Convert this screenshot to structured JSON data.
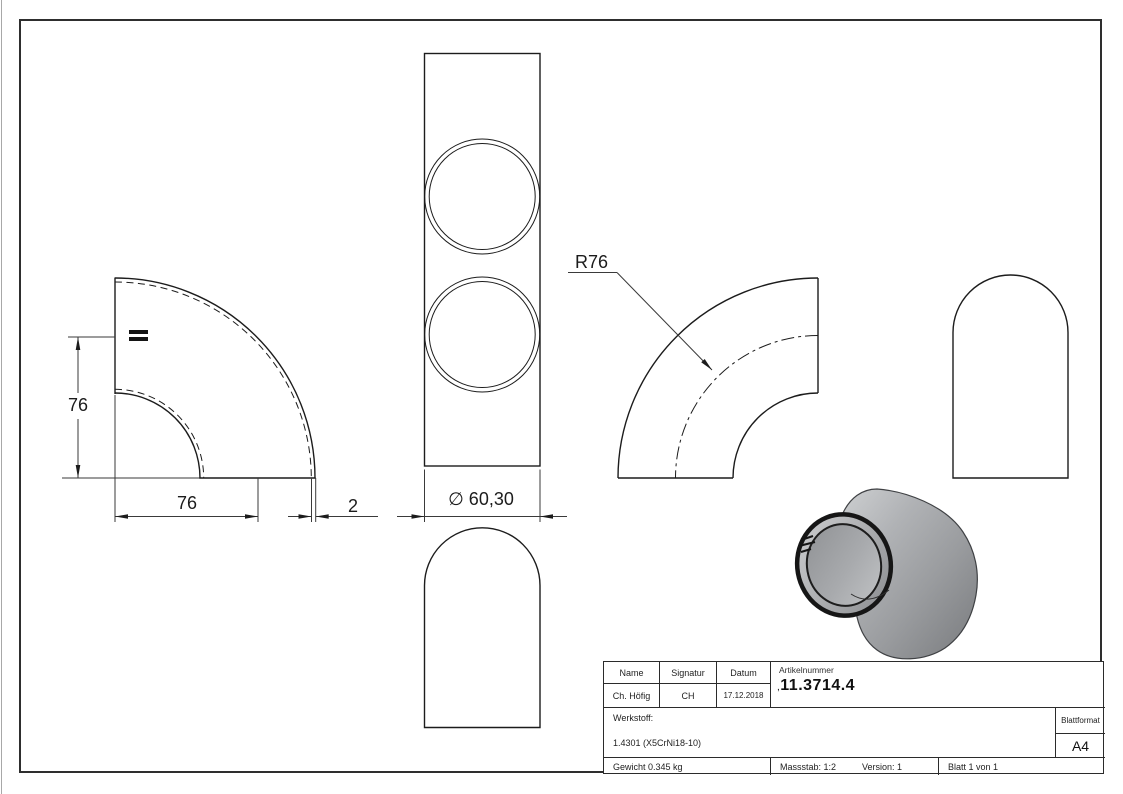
{
  "colors": {
    "line": "#1c1c1c",
    "dim_line": "#3a3a3a",
    "border": "#2e2e2e",
    "render_body_gray": "#a4a6a9",
    "render_rim_black": "#161616"
  },
  "dims": {
    "height": "76",
    "length": "76",
    "wall": "2",
    "diameter": "∅ 60,30",
    "radius": "R76"
  },
  "title_block": {
    "headers": {
      "name": "Name",
      "signature": "Signatur",
      "date": "Datum"
    },
    "values": {
      "name": "Ch. Höfig",
      "signature": "CH",
      "date": "17.12.2018"
    },
    "article": {
      "label": "Artikelnummer",
      "prefix": ",",
      "number": "11.3714.4"
    },
    "surface": {
      "label": "Oberfläche:",
      "value": "Geschliffen Korn 240"
    },
    "material": {
      "label": "Werkstoff:",
      "value": "1.4301 (X5CrNi18-10)"
    },
    "sheet_format": {
      "label": "Blattformat",
      "value": "A4"
    },
    "weight": "Gewicht 0.345 kg",
    "scale": "Massstab: 1:2",
    "version": "Version: 1",
    "sheet": "Blatt 1 von 1"
  }
}
